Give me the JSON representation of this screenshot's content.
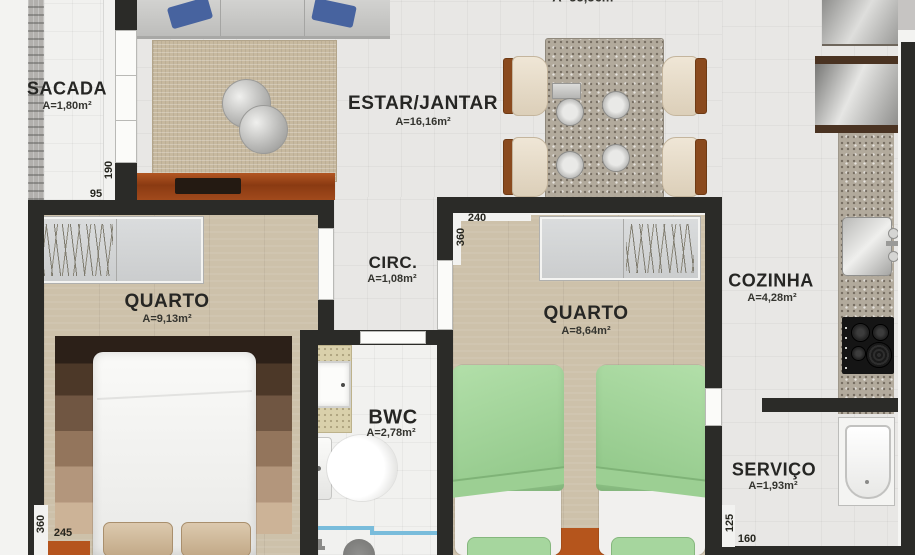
{
  "header": {
    "partial_area_label": "A=55,56m²"
  },
  "rooms": {
    "sacada": {
      "name": "SACADA",
      "area": "A=1,80m²"
    },
    "estar_jantar": {
      "name": "ESTAR/JANTAR",
      "area": "A=16,16m²"
    },
    "circ": {
      "name": "CIRC.",
      "area": "A=1,08m²"
    },
    "quarto1": {
      "name": "QUARTO",
      "area": "A=9,13m²"
    },
    "quarto2": {
      "name": "QUARTO",
      "area": "A=8,64m²"
    },
    "cozinha": {
      "name": "COZINHA",
      "area": "A=4,28m²"
    },
    "bwc": {
      "name": "BWC",
      "area": "A=2,78m²"
    },
    "servico": {
      "name": "SERVIÇO",
      "area": "A=1,93m²"
    }
  },
  "dimensions": {
    "sacada_depth": "95",
    "sacada_door_width": "190",
    "quarto1_width": "245",
    "quarto1_depth": "360",
    "quarto2_width": "240",
    "quarto2_depth": "360",
    "servico_width": "160",
    "servico_depth": "125"
  },
  "colors": {
    "wall": "#2b2b28",
    "wood_floor": "#cdc1aa",
    "tile_floor": "#e8e7e5",
    "bed_green": "#a3d49c",
    "rack_orange": "#a04a1c",
    "shower_glass": "#79bcdb"
  }
}
